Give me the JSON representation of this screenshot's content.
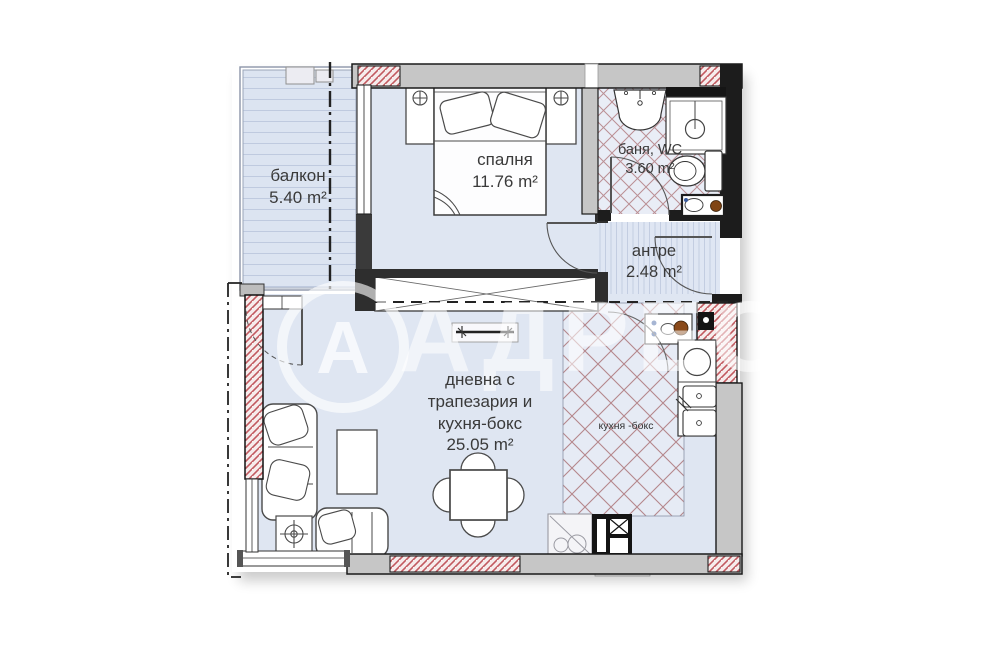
{
  "watermark": {
    "logo_letter": "А",
    "brand": "АДРЕС"
  },
  "rooms": {
    "balcony": {
      "name": "балкон",
      "area": "5.40 m²"
    },
    "bedroom": {
      "name": "спалня",
      "area": "11.76 m²"
    },
    "bathroom": {
      "name": "баня, WC",
      "area": "3.60 m²"
    },
    "hallway": {
      "name": "антре",
      "area": "2.48 m²"
    },
    "living": {
      "line1": "дневна с",
      "line2": "трапезария и",
      "line3": "кухня-бокс",
      "area": "25.05 m²"
    },
    "kitchen": {
      "name": "кухня -бокс"
    }
  },
  "colors": {
    "floor": "#dfe6f2",
    "wall_gray": "#c6c6c6",
    "wall_dark": "#1c1c1c",
    "hatch_red": "#c25a60",
    "tile_line": "#b5878c",
    "text": "#3a3a3a"
  }
}
